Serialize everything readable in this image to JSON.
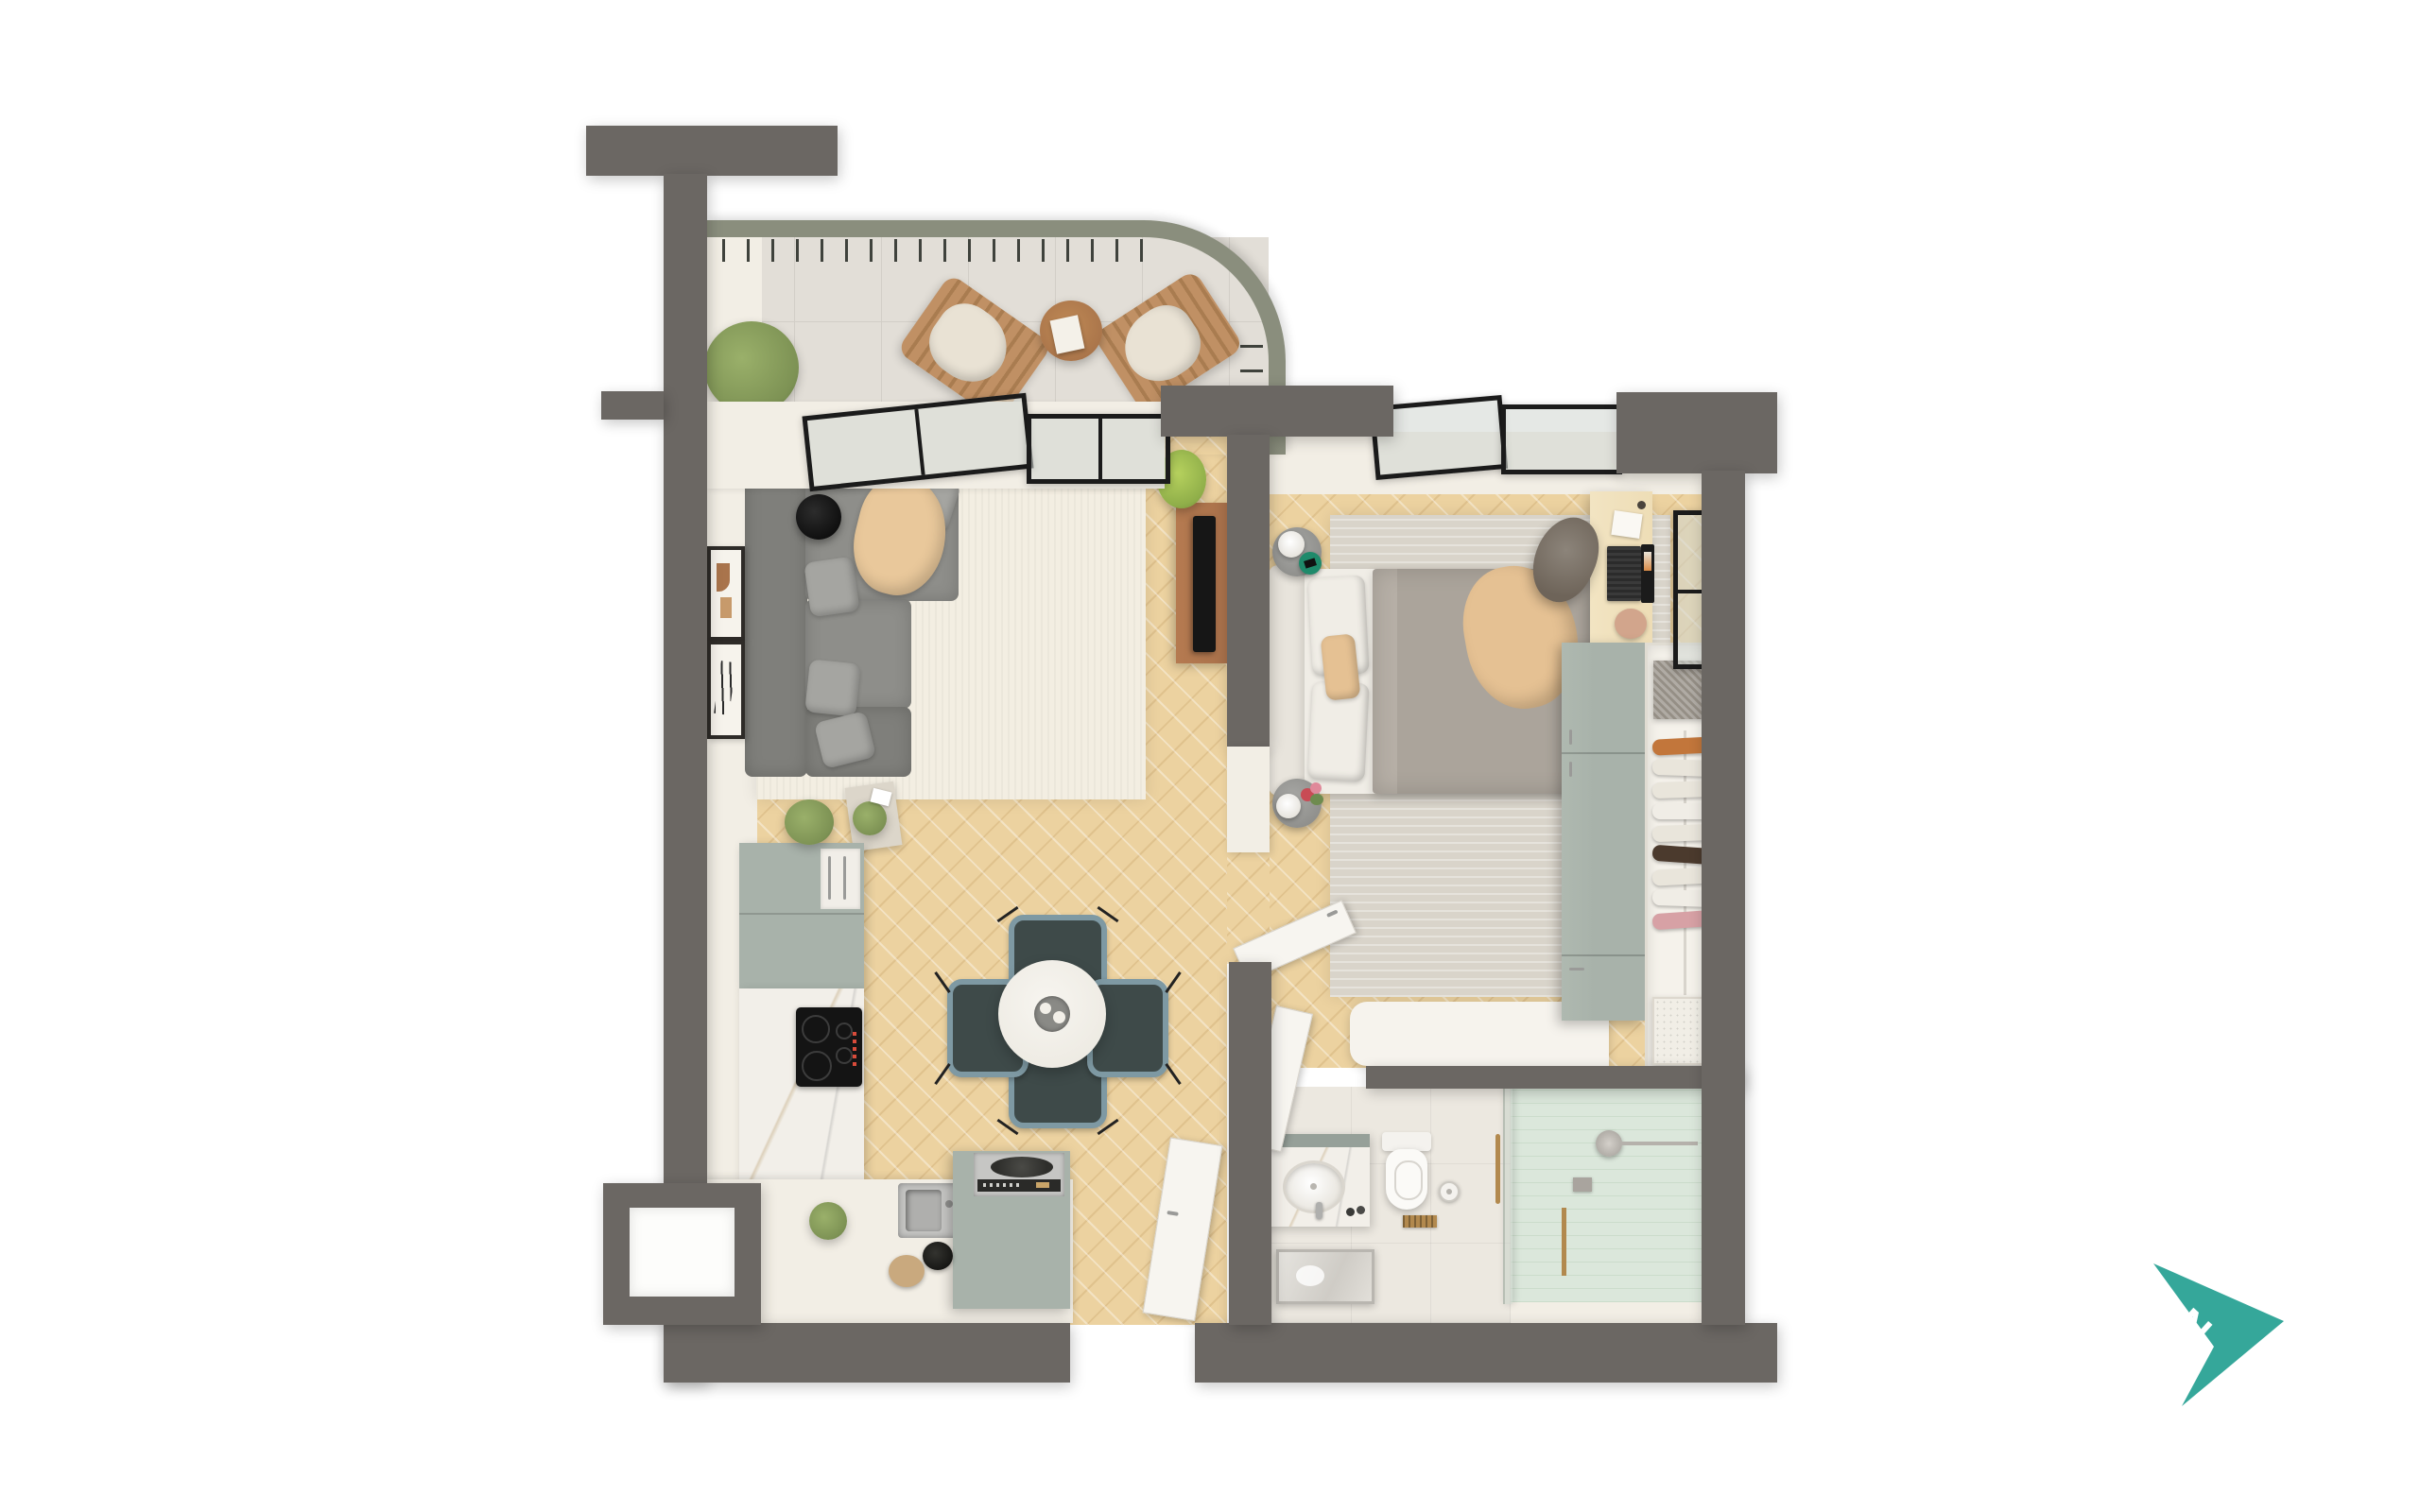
{
  "scene": {
    "description": "3D top-down render of a one-bedroom apartment floor plan on a white background",
    "background": "#FFFFFF"
  },
  "compass": {
    "letter": "N",
    "color": "#35A79A"
  },
  "palette": {
    "bg": "#FFFFFF",
    "wall": "#6B6763",
    "cream": "#F2EEE5",
    "creamDark": "#E7E2D8",
    "wood": "#ECD2A0",
    "tile": "#E2DED7",
    "tileLine": "#D2CEC7",
    "railing": "#8A8E7D",
    "baluster": "#3F423C",
    "rugLiving": "#F3EEE2",
    "rugBed": "#D9D4CA",
    "sofa": "#8E8E8A",
    "sofaDark": "#7F7F7B",
    "pillow": "#A5A5A1",
    "throw": "#E9C89B",
    "black": "#161616",
    "tvwood": "#A9714B",
    "sage": "#A8B2AA",
    "sageDark": "#96A099",
    "marble": "#F2EFE9",
    "steel": "#C6C6C4",
    "tealChair": "#3E4A49",
    "tealChairEdge": "#7E99A3",
    "bedDuvet": "#ABA49B",
    "bedSheet": "#F0EDE6",
    "tan": "#E5C193",
    "nstand": "#9A9A97",
    "trayGreen": "#1F8A6B",
    "plant": "#7D9254",
    "plantLight": "#9AB06A",
    "deskWood": "#EEDDB6",
    "chairBrown": "#6E6459",
    "closetBg": "#F5F2EB",
    "boxGray": "#958F86",
    "basket": "#F1EEE6",
    "clothOrange": "#C2763B",
    "clothCream": "#E9E5DB",
    "clothWhite": "#F0EDE6",
    "clothDark": "#4B3A2D",
    "clothPink": "#D7A1A5",
    "bathFloor": "#ECE8E0",
    "mint": "#DBE7DB",
    "mintLine": "#CBDCCB",
    "brass": "#B2894E",
    "toiletWhite": "#FBFAF7",
    "mirror": "#D8D5CF",
    "frameBlack": "#1B1B1B",
    "door": "#F7F5F0",
    "doorEdge": "#D8D4CC",
    "handle": "#9A9A98",
    "compass": "#35A79A"
  },
  "rooms": [
    {
      "name": "balcony",
      "furniture": [
        "shrub-plant",
        "wooden-lounge-chair",
        "wooden-lounge-chair",
        "round-wood-table",
        "curved-railing"
      ]
    },
    {
      "name": "living-room",
      "furniture": [
        "gray-sectional-sofa",
        "throw-pillows",
        "tan-throw-blanket",
        "black-round-side-table",
        "cream-area-rug",
        "wall-art-frame",
        "wall-art-frame",
        "tv-console",
        "tv",
        "fern-plant",
        "plant-side-table"
      ]
    },
    {
      "name": "dining-area",
      "furniture": [
        "round-white-table",
        "serving-tray-with-cups",
        "dining-chair",
        "dining-chair",
        "dining-chair",
        "dining-chair"
      ]
    },
    {
      "name": "kitchen",
      "furniture": [
        "sage-upper-cabinets",
        "white-cabinet",
        "marble-counter",
        "induction-cooktop",
        "steel-sink",
        "sage-island-with-cooker",
        "black-bowl",
        "round-cutting-board",
        "herb-plant"
      ]
    },
    {
      "name": "bedroom",
      "furniture": [
        "double-bed",
        "white-pillows",
        "tan-accent-pillow",
        "gray-duvet",
        "tan-throw",
        "round-nightstand-with-lamp",
        "round-nightstand-with-flowers",
        "gray-area-rug",
        "wood-desk",
        "laptop",
        "notebook",
        "desk-chair",
        "white-console-ledge"
      ]
    },
    {
      "name": "wardrobe",
      "furniture": [
        "sage-cabinet",
        "open-closet",
        "hanging-clothes-rail",
        "storage-box",
        "laundry-basket"
      ]
    },
    {
      "name": "bathroom",
      "furniture": [
        "marble-vanity",
        "round-sink",
        "mirror",
        "toilet",
        "toilet-paper-holder",
        "glass-shower-screen",
        "shower-head",
        "brass-handle",
        "floor-drain"
      ]
    },
    {
      "name": "hallway",
      "furniture": [
        "entrance-door",
        "bedroom-door",
        "bathroom-door"
      ]
    }
  ],
  "hanging_clothes_colors": [
    "orange",
    "cream",
    "cream",
    "white",
    "cream",
    "dark-brown",
    "cream",
    "white",
    "pink"
  ]
}
